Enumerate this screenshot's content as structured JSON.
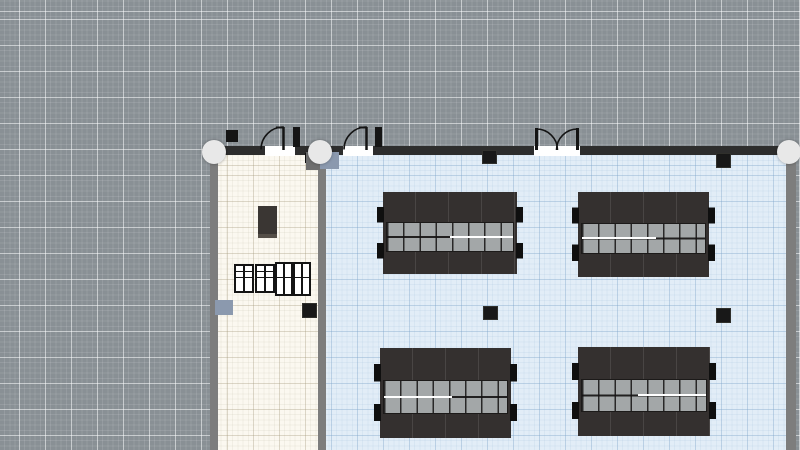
{
  "app": {
    "name": "floor-plan-editor",
    "view": "2d-plan-canvas"
  },
  "colors": {
    "canvas-bg": "#899095",
    "floor-annex": "#fbf8f0",
    "floor-hall": "#e2edf7",
    "wall-gray": "#7d7d7d",
    "wall-dark": "#2d2d2d",
    "handle": "#e8e8e8",
    "column": "#181818",
    "table-base": "#34302f",
    "seat": "#a3a7a8",
    "accent-box": "#8b99ae",
    "annex-table": "#3a3633"
  },
  "canvas": {
    "grid_major_spacing_px": 26,
    "grid_fine_spacing_px": 5.2,
    "grid_offset_px": 19
  },
  "selection_handles": [
    {
      "id": "wall-endpoint-left",
      "cx": 214,
      "cy": 152
    },
    {
      "id": "wall-joint-middle",
      "cx": 320,
      "cy": 152
    },
    {
      "id": "wall-endpoint-right",
      "cx": 789,
      "cy": 152
    }
  ],
  "rooms": [
    {
      "id": "annex",
      "floor": "ivory",
      "x": 218,
      "y": 154,
      "w": 100,
      "h": 296
    },
    {
      "id": "hall",
      "floor": "light-blue",
      "x": 326,
      "y": 154,
      "w": 460,
      "h": 296
    }
  ],
  "doors": [
    {
      "id": "annex-door",
      "type": "single-swing-out",
      "hinge_x": 283,
      "opening": [
        261,
        295
      ]
    },
    {
      "id": "hall-door-left",
      "type": "single-swing-out",
      "hinge_x": 366,
      "opening": [
        344,
        374
      ]
    },
    {
      "id": "hall-door-double",
      "type": "double-swing-out",
      "opening": [
        536,
        578
      ]
    }
  ],
  "columns": [
    {
      "x": 482,
      "y": 150
    },
    {
      "x": 716,
      "y": 153
    },
    {
      "x": 483,
      "y": 306
    },
    {
      "x": 716,
      "y": 308
    },
    {
      "x": 302,
      "y": 303
    }
  ],
  "furniture": {
    "annex": {
      "cabinet_units": 4,
      "small_table": 1,
      "wall_mounted_box": 1
    },
    "hall": {
      "table_groups": 4,
      "group_layout": {
        "seat_rows": 2,
        "seats_per_row": 8
      },
      "group_positions": [
        {
          "x": 383,
          "y": 192,
          "w": 134,
          "h": 82
        },
        {
          "x": 578,
          "y": 192,
          "w": 131,
          "h": 85
        },
        {
          "x": 380,
          "y": 348,
          "w": 131,
          "h": 90
        },
        {
          "x": 578,
          "y": 347,
          "w": 132,
          "h": 89
        }
      ]
    }
  },
  "titles": {
    "handle": "wall drag handle",
    "canvas": "plan canvas"
  }
}
